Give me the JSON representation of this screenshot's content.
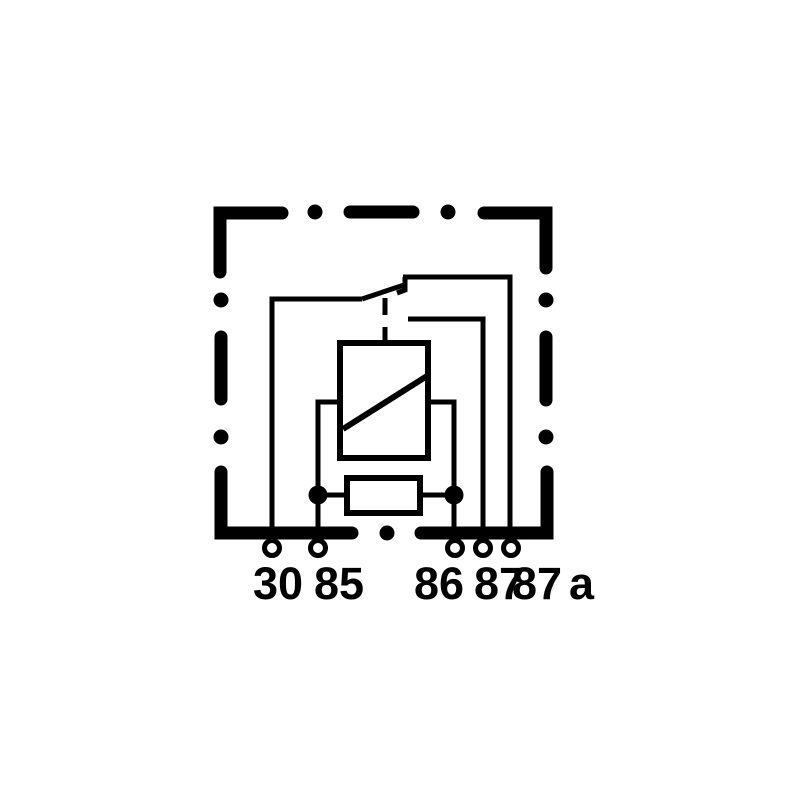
{
  "diagram": {
    "kind": "relay-wiring-schematic",
    "background_color": "#ffffff",
    "line_color": "#000000",
    "terminal_ids": [
      "30",
      "85",
      "86",
      "87",
      "87a"
    ],
    "terminal_labels": [
      {
        "text": "30"
      },
      {
        "text": "85"
      },
      {
        "text": "86"
      },
      {
        "text": "87"
      },
      {
        "text": "87"
      },
      {
        "text": "a"
      }
    ]
  }
}
